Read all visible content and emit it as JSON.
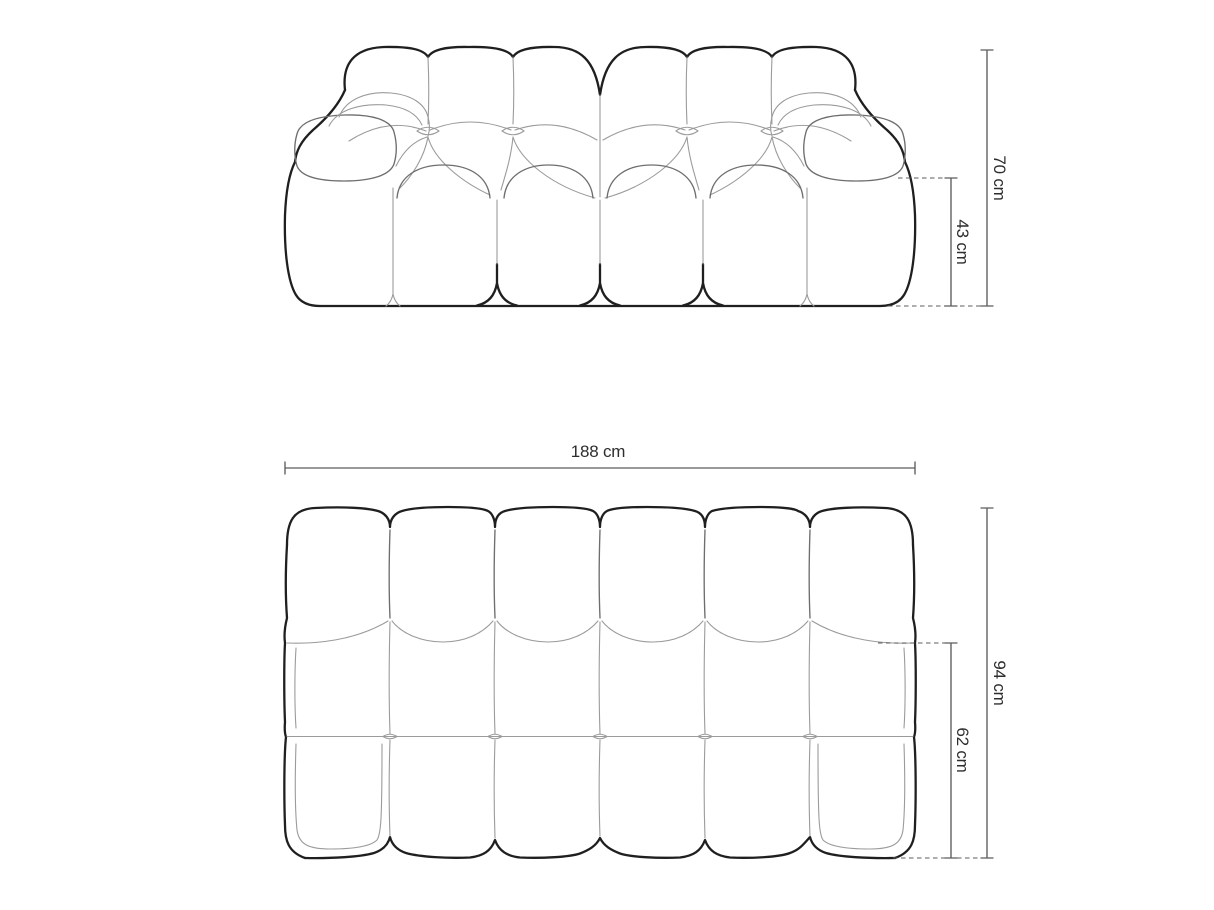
{
  "diagram": {
    "subject": "modular sofa dimension drawing",
    "views": {
      "front": {
        "name": "front elevation",
        "dimensions": {
          "overall_height": {
            "value": 70,
            "unit": "cm",
            "label": "70 cm"
          },
          "seat_height": {
            "value": 43,
            "unit": "cm",
            "label": "43 cm"
          }
        }
      },
      "top": {
        "name": "top plan",
        "dimensions": {
          "overall_width": {
            "value": 188,
            "unit": "cm",
            "label": "188 cm"
          },
          "overall_depth": {
            "value": 94,
            "unit": "cm",
            "label": "94 cm"
          },
          "seat_depth": {
            "value": 62,
            "unit": "cm",
            "label": "62 cm"
          }
        }
      }
    },
    "style": {
      "background": "#ffffff",
      "outline_color": "#1f1f1f",
      "mid_line_color": "#6e6e6e",
      "inner_line_color": "#9b9b9b",
      "dimension_line_color": "#5c5c5c",
      "label_color": "#2e2e2e"
    }
  }
}
